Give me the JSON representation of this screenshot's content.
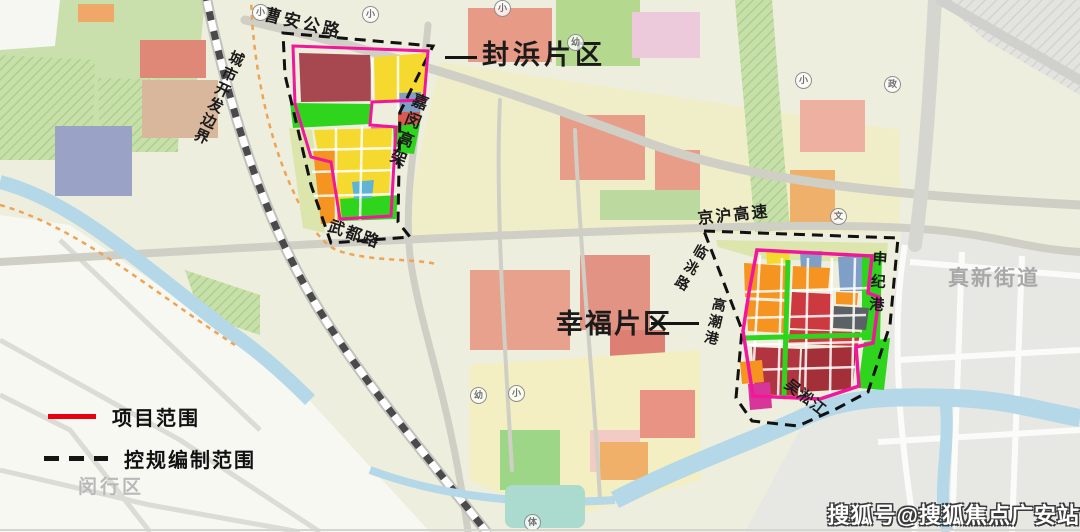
{
  "map": {
    "region_labels": {
      "fengbang": "封浜片区",
      "xingfu": "幸福片区",
      "zhenxin": "真新街道",
      "minhang": "闵行区"
    },
    "road_labels": {
      "caoan": "曹安公路",
      "chengshi_kaifa": "城市开发边界",
      "jiamin": "嘉闵高架",
      "wudu": "武都路",
      "jinghu": "京沪高速",
      "lintao": "临洮路",
      "gaochao": "高潮港",
      "shenji": "申纪港",
      "wusong": "吴淞江"
    },
    "pois": [
      {
        "char": "小"
      },
      {
        "char": "小"
      },
      {
        "char": "小"
      },
      {
        "char": "幼"
      },
      {
        "char": "小"
      },
      {
        "char": "政"
      },
      {
        "char": "文"
      },
      {
        "char": "幼"
      },
      {
        "char": "小"
      },
      {
        "char": "体"
      }
    ]
  },
  "legend": {
    "items": [
      {
        "label": "项目范围"
      },
      {
        "label": "控规编制范围"
      }
    ],
    "project_scope_color": "#e60012",
    "plan_boundary_color": "#111111"
  },
  "colors": {
    "project_outline_on_map": "#f2169b",
    "plan_boundary_on_map": "#111111",
    "river": "#b4d8e8",
    "district_label_gray": "#a8a8a8"
  },
  "watermark": "搜狐号@搜狐焦点广安站"
}
